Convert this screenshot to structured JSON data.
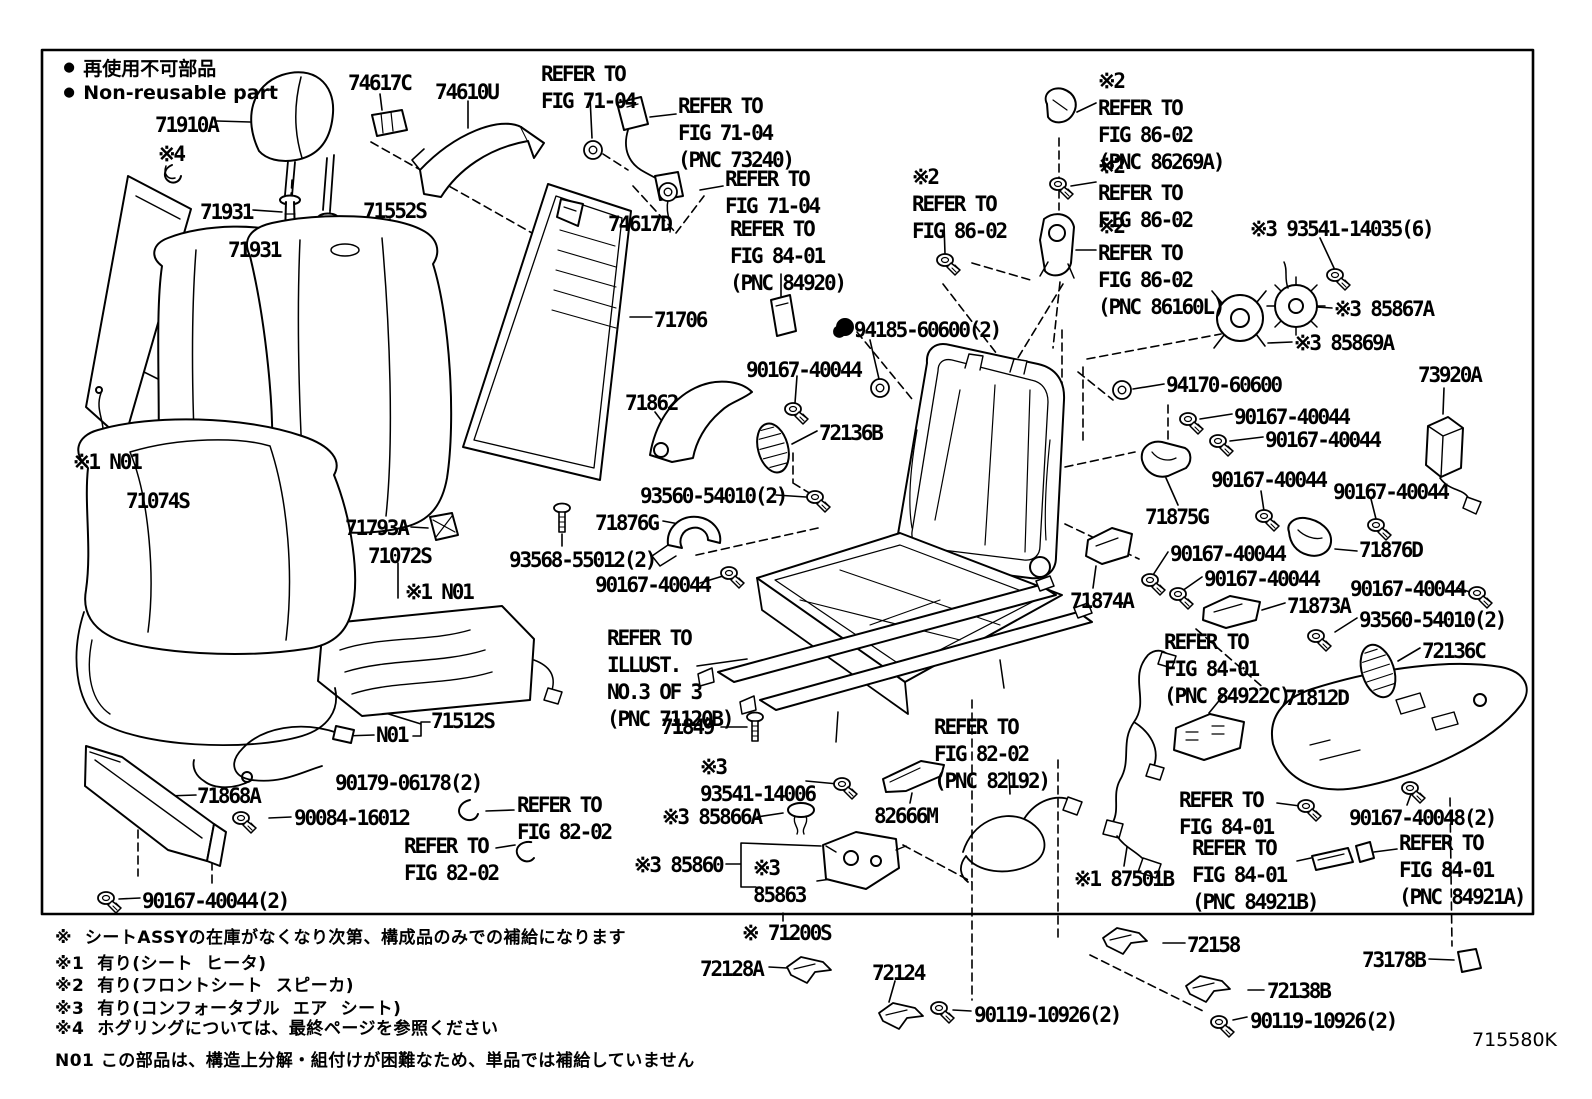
{
  "legend": {
    "bullet": "●",
    "jp": "再使用不可部品",
    "en": "Non-reusable part"
  },
  "diagram_code": "715580K",
  "notes": [
    "※  シートASSYの在庫がなくなり次第、構成品のみでの補給になります",
    "※1  有り(シート  ヒータ)",
    "※2  有り(フロントシート  スピーカ)",
    "※3  有り(コンフォータブル  エア  シート)",
    "※4  ホグリングについては、最終ページを参照ください",
    "N01 この部品は、構造上分解・組付けが困難なため、単品では補給していません"
  ],
  "labels": [
    {
      "t": "71910A",
      "x": 155,
      "y": 112
    },
    {
      "t": "※4",
      "x": 158,
      "y": 141
    },
    {
      "t": "71931",
      "x": 200,
      "y": 199
    },
    {
      "t": "71931",
      "x": 228,
      "y": 237
    },
    {
      "t": "74617C",
      "x": 348,
      "y": 70
    },
    {
      "t": "74610U",
      "x": 435,
      "y": 79
    },
    {
      "t": "REFER TO\nFIG 71-04",
      "x": 541,
      "y": 61
    },
    {
      "t": "REFER TO\nFIG 71-04\n(PNC 73240)",
      "x": 678,
      "y": 93
    },
    {
      "t": "REFER TO\nFIG 71-04",
      "x": 725,
      "y": 166
    },
    {
      "t": "74617D",
      "x": 608,
      "y": 211
    },
    {
      "t": "REFER TO\nFIG 84-01\n(PNC 84920)",
      "x": 730,
      "y": 216
    },
    {
      "t": "71552S",
      "x": 363,
      "y": 198
    },
    {
      "t": "71706",
      "x": 654,
      "y": 307
    },
    {
      "t": "● 94185-60600(2)",
      "x": 833,
      "y": 317
    },
    {
      "t": "※2\nREFER TO\nFIG 86-02",
      "x": 912,
      "y": 164
    },
    {
      "t": "※2\nREFER TO\nFIG 86-02\n(PNC 86269A)",
      "x": 1098,
      "y": 68
    },
    {
      "t": "※2\nREFER TO\nFIG 86-02",
      "x": 1098,
      "y": 153
    },
    {
      "t": "※2\nREFER TO\nFIG 86-02\n(PNC 86160L)",
      "x": 1098,
      "y": 213
    },
    {
      "t": "※3 93541-14035(6)",
      "x": 1250,
      "y": 216
    },
    {
      "t": "※3 85867A",
      "x": 1334,
      "y": 296
    },
    {
      "t": "※3 85869A",
      "x": 1294,
      "y": 330
    },
    {
      "t": "73920A",
      "x": 1418,
      "y": 362
    },
    {
      "t": "94170-60600",
      "x": 1166,
      "y": 372
    },
    {
      "t": "90167-40044",
      "x": 1234,
      "y": 404
    },
    {
      "t": "90167-40044",
      "x": 1265,
      "y": 427
    },
    {
      "t": "90167-40044",
      "x": 1211,
      "y": 467
    },
    {
      "t": "90167-40044",
      "x": 1333,
      "y": 479
    },
    {
      "t": "71875G",
      "x": 1145,
      "y": 504
    },
    {
      "t": "90167-40044",
      "x": 1170,
      "y": 541
    },
    {
      "t": "90167-40044",
      "x": 1204,
      "y": 566
    },
    {
      "t": "71876D",
      "x": 1359,
      "y": 537
    },
    {
      "t": "71874A",
      "x": 1070,
      "y": 588
    },
    {
      "t": "71873A",
      "x": 1287,
      "y": 593
    },
    {
      "t": "90167-40044",
      "x": 1350,
      "y": 576
    },
    {
      "t": "93560-54010(2)",
      "x": 1359,
      "y": 607
    },
    {
      "t": "72136C",
      "x": 1422,
      "y": 638
    },
    {
      "t": "71812D",
      "x": 1285,
      "y": 685
    },
    {
      "t": "REFER TO\nFIG 84-01\n(PNC 84922C)",
      "x": 1164,
      "y": 629
    },
    {
      "t": "REFER TO\nFIG 84-01",
      "x": 1179,
      "y": 787
    },
    {
      "t": "90167-40048(2)",
      "x": 1349,
      "y": 805
    },
    {
      "t": "REFER TO\nFIG 84-01\n(PNC 84921B)",
      "x": 1192,
      "y": 835
    },
    {
      "t": "REFER TO\nFIG 84-01\n(PNC 84921A)",
      "x": 1399,
      "y": 830
    },
    {
      "t": "※1 87501B",
      "x": 1074,
      "y": 866
    },
    {
      "t": "71862",
      "x": 625,
      "y": 390
    },
    {
      "t": "90167-40044",
      "x": 746,
      "y": 357
    },
    {
      "t": "72136B",
      "x": 819,
      "y": 420
    },
    {
      "t": "93560-54010(2)",
      "x": 640,
      "y": 483
    },
    {
      "t": "71876G",
      "x": 595,
      "y": 510
    },
    {
      "t": "93568-55012(2)",
      "x": 509,
      "y": 547
    },
    {
      "t": "90167-40044",
      "x": 595,
      "y": 572
    },
    {
      "t": "※1 N01",
      "x": 73,
      "y": 449
    },
    {
      "t": "71074S",
      "x": 126,
      "y": 488
    },
    {
      "t": "71793A",
      "x": 345,
      "y": 515
    },
    {
      "t": "71072S",
      "x": 368,
      "y": 543
    },
    {
      "t": "※1 N01",
      "x": 405,
      "y": 579
    },
    {
      "t": "REFER TO\nILLUST.\nNO.3 OF 3\n(PNC 71120B)",
      "x": 607,
      "y": 625
    },
    {
      "t": "71849",
      "x": 661,
      "y": 714
    },
    {
      "t": "※3\n93541-14006",
      "x": 700,
      "y": 754
    },
    {
      "t": "※3 85866A",
      "x": 662,
      "y": 804
    },
    {
      "t": "※3 85860",
      "x": 634,
      "y": 852
    },
    {
      "t": "※3\n85863",
      "x": 753,
      "y": 855
    },
    {
      "t": "82666M",
      "x": 874,
      "y": 803
    },
    {
      "t": "REFER TO\nFIG 82-02\n(PNC 82192)",
      "x": 934,
      "y": 714
    },
    {
      "t": "71512S",
      "x": 431,
      "y": 708
    },
    {
      "t": "N01",
      "x": 376,
      "y": 722
    },
    {
      "t": "90179-06178(2)",
      "x": 335,
      "y": 770
    },
    {
      "t": "71868A",
      "x": 197,
      "y": 783
    },
    {
      "t": "90084-16012",
      "x": 294,
      "y": 805
    },
    {
      "t": "REFER TO\nFIG 82-02",
      "x": 517,
      "y": 792
    },
    {
      "t": "REFER TO\nFIG 82-02",
      "x": 404,
      "y": 833
    },
    {
      "t": "90167-40044(2)",
      "x": 142,
      "y": 888
    },
    {
      "t": "※ 71200S",
      "x": 742,
      "y": 920
    },
    {
      "t": "72128A",
      "x": 700,
      "y": 956
    },
    {
      "t": "72124",
      "x": 872,
      "y": 960
    },
    {
      "t": "90119-10926(2)",
      "x": 974,
      "y": 1002
    },
    {
      "t": "72158",
      "x": 1187,
      "y": 932
    },
    {
      "t": "72138B",
      "x": 1267,
      "y": 978
    },
    {
      "t": "90119-10926(2)",
      "x": 1250,
      "y": 1008
    },
    {
      "t": "73178B",
      "x": 1362,
      "y": 947
    }
  ]
}
